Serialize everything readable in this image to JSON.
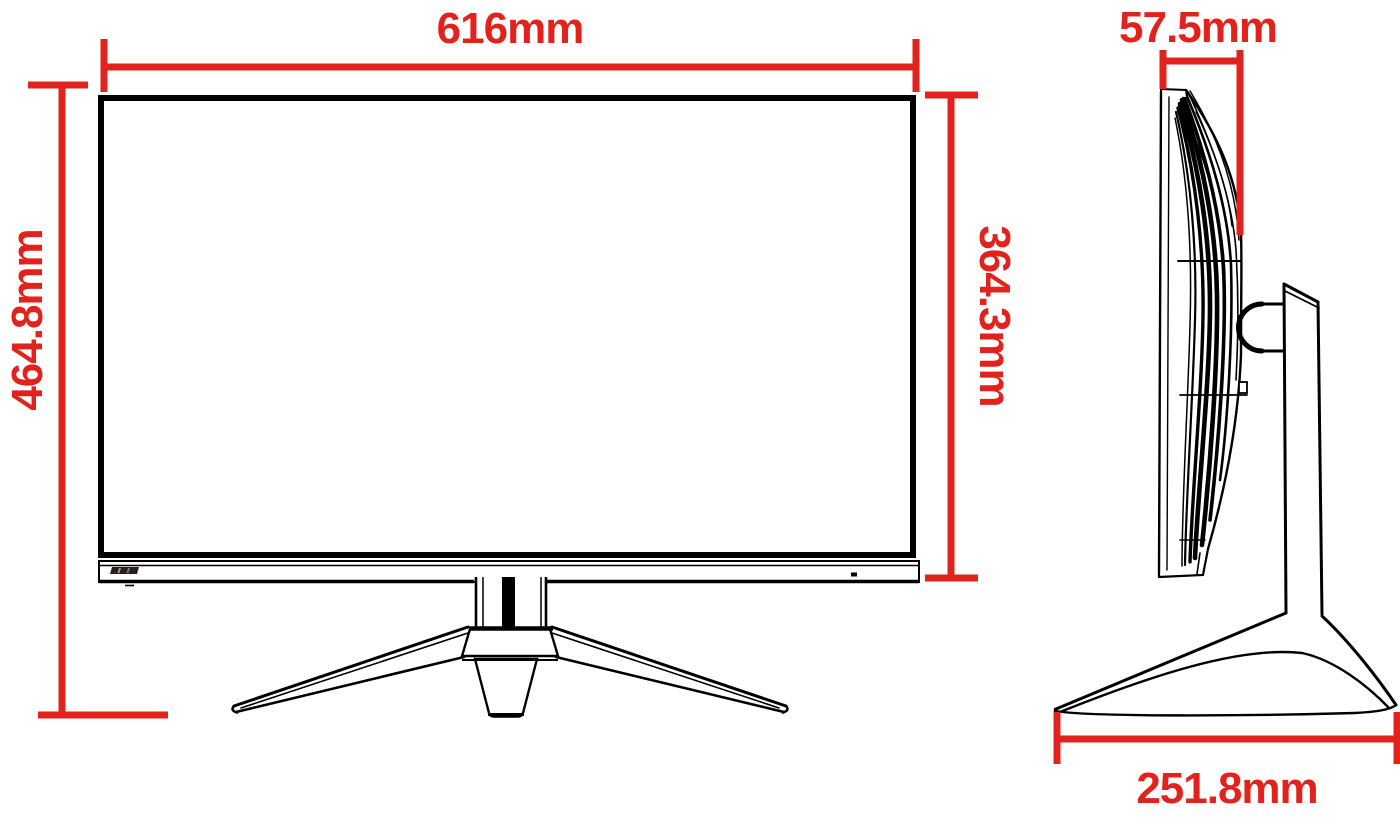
{
  "diagram": {
    "accent_color": "#E2231D",
    "line_color": "#000000",
    "views": {
      "front": {
        "width": "616mm",
        "total_height": "464.8mm",
        "screen_height": "364.3mm"
      },
      "side": {
        "depth": "57.5mm",
        "base_depth": "251.8mm"
      }
    }
  }
}
